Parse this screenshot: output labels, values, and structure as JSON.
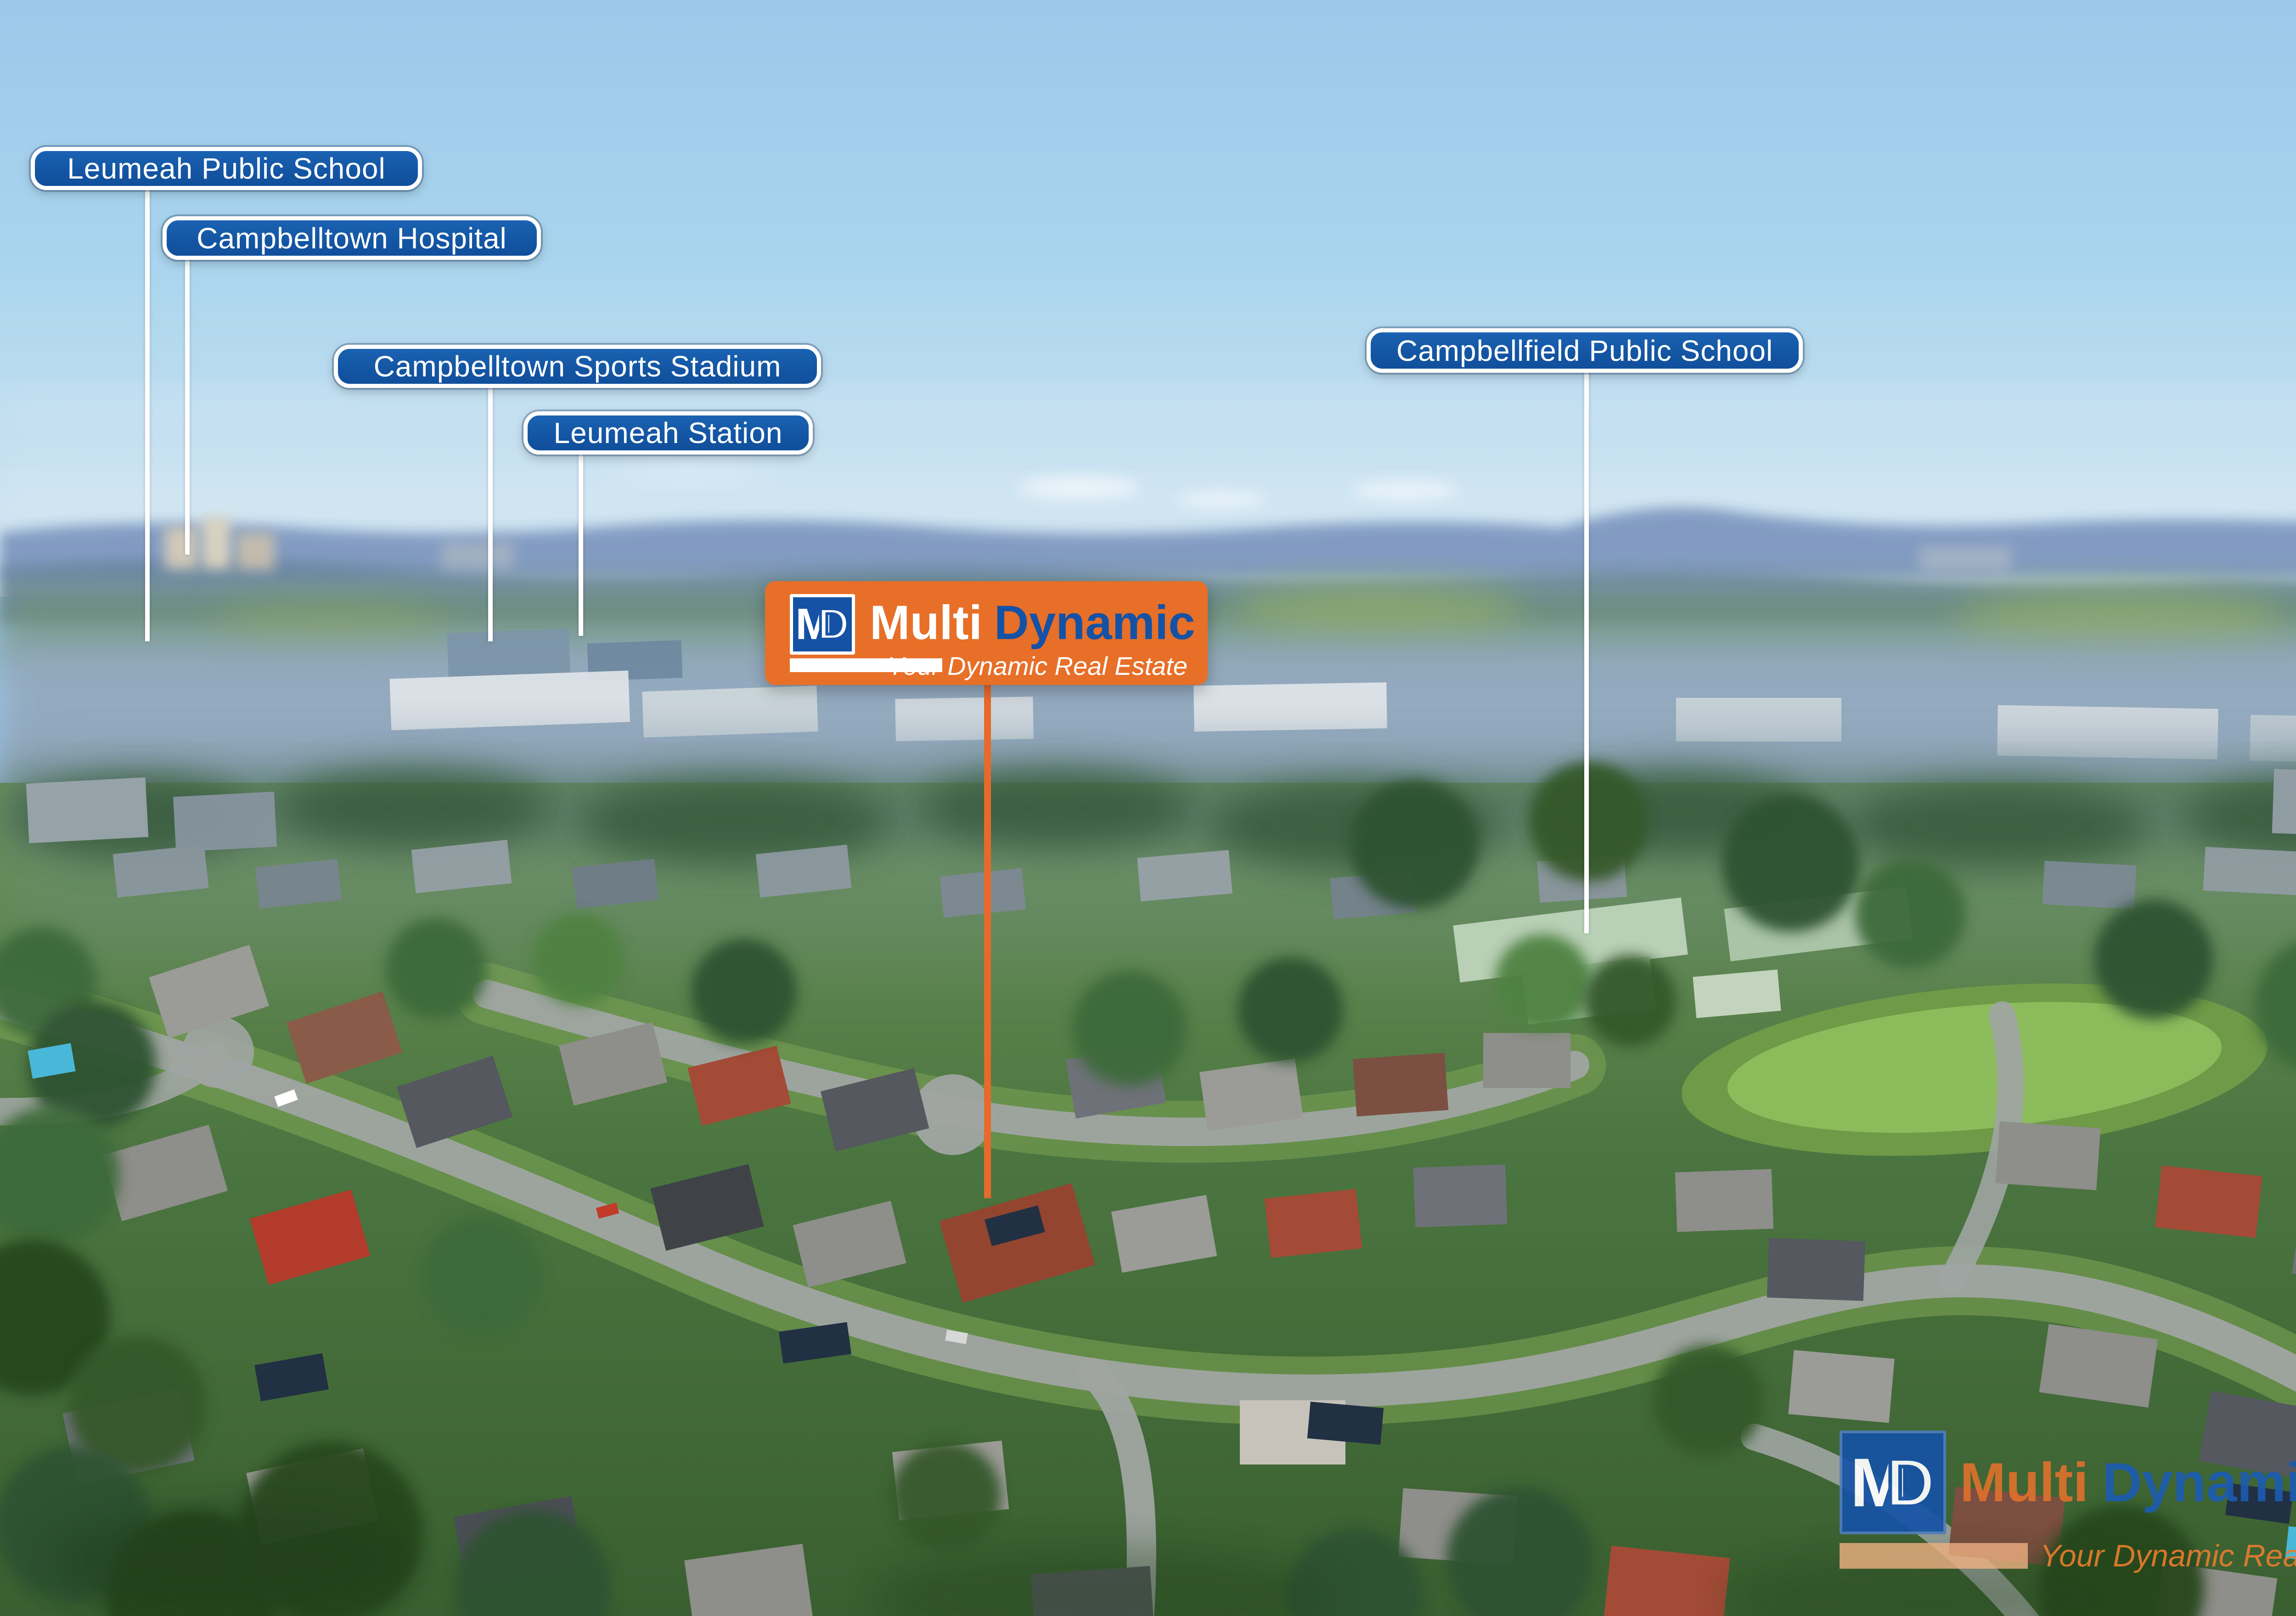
{
  "annotations": {
    "labels": [
      {
        "id": "leumeah-public-school",
        "text": "Leumeah Public School"
      },
      {
        "id": "campbelltown-hospital",
        "text": "Campbelltown Hospital"
      },
      {
        "id": "campbelltown-sports-stadium",
        "text": "Campbelltown Sports Stadium"
      },
      {
        "id": "leumeah-station",
        "text": "Leumeah Station"
      },
      {
        "id": "campbellfield-public-school",
        "text": "Campbellfield Public School"
      }
    ]
  },
  "branding": {
    "banner": {
      "logo_m": "M",
      "logo_d": "D",
      "brand_primary": "Multi",
      "brand_secondary": "Dynamic",
      "tagline": "Your Dynamic Real Estate"
    },
    "watermark": {
      "logo_m": "M",
      "logo_d": "D",
      "brand_primary": "Multi",
      "brand_secondary": "Dynamic",
      "tagline": "Your Dynamic Real Estate"
    }
  },
  "colors": {
    "label_blue": "#1456a4",
    "label_border": "#ffffff",
    "leader_line": "#ffffff",
    "banner_orange": "#e76f28",
    "brand_blue": "#1552a5",
    "property_line_orange": "#e7692c",
    "watermark_orange": "#de702c",
    "watermark_blue": "#1d5cb0",
    "watermark_tagline_orange": "#e57c2e",
    "sky_top": "#9cc8ea",
    "sky_horizon": "#d9e9f3"
  }
}
